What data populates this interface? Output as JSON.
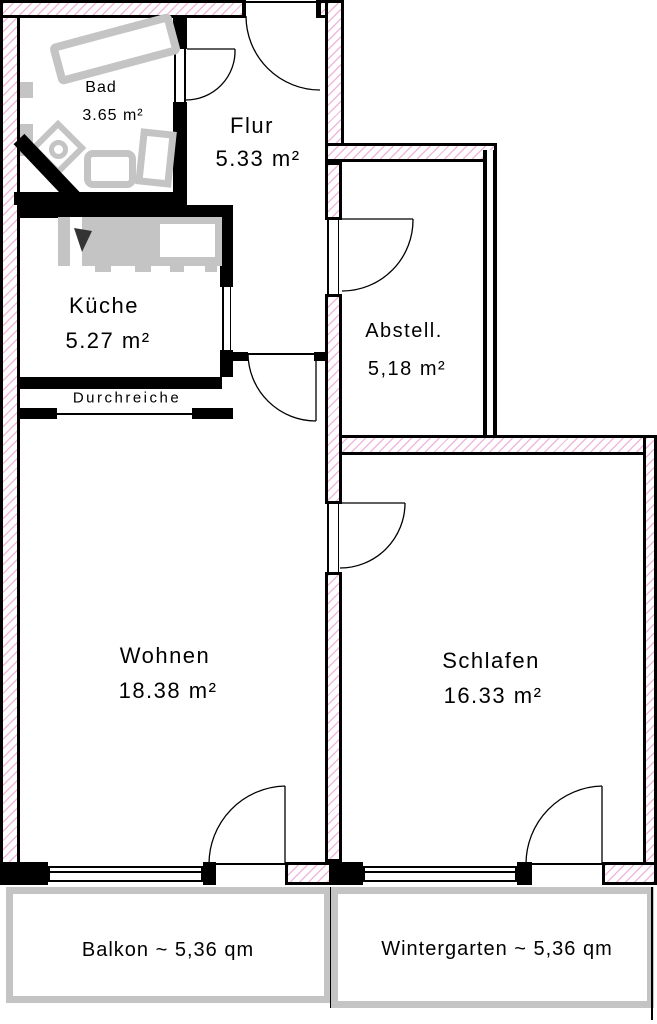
{
  "rooms": [
    {
      "id": "bad",
      "name": "Bad",
      "area": "3.65 m²"
    },
    {
      "id": "flur",
      "name": "Flur",
      "area": "5.33 m²"
    },
    {
      "id": "kueche",
      "name": "Küche",
      "area": "5.27 m²"
    },
    {
      "id": "abstell",
      "name": "Abstell.",
      "area": "5,18 m²"
    },
    {
      "id": "wohnen",
      "name": "Wohnen",
      "area": "18.38 m²"
    },
    {
      "id": "schlafen",
      "name": "Schlafen",
      "area": "16.33 m²"
    }
  ],
  "annotations": {
    "durchreiche": "Durchreiche"
  },
  "outdoor": [
    {
      "id": "balkon",
      "label": "Balkon ~ 5,36 qm"
    },
    {
      "id": "wintergarten",
      "label": "Wintergarten ~ 5,36 qm"
    }
  ],
  "colors": {
    "wall": "#000000",
    "wall_hatch": "#efb9de",
    "fixture": "#c4c4c4",
    "outdoor_border": "#c4c4c4",
    "background": "#ffffff"
  }
}
